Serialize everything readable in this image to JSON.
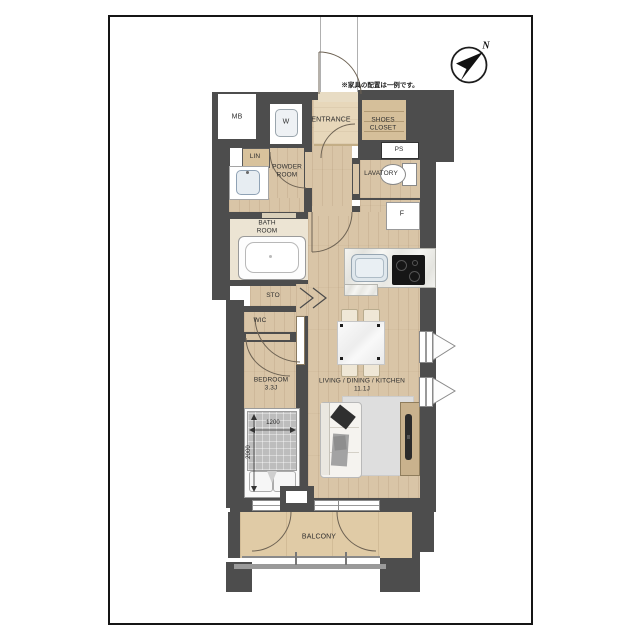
{
  "page": {
    "compass_n": "N",
    "furniture_note": "※家具の配置は一例です。"
  },
  "rooms": {
    "mb": "MB",
    "w": "W",
    "entrance": "ENTRANCE",
    "shoes_closet": "SHOES\nCLOSET",
    "ps": "PS",
    "lin": "LIN",
    "powder_room": "POWDER\nROOM",
    "lavatory": "LAVATORY",
    "bath_room": "BATH\nROOM",
    "f": "F",
    "sto": "STO",
    "wic": "WIC",
    "bedroom": "BEDROOM\n3.3J",
    "ldk": "LIVING / DINING / KITCHEN\n11.1J",
    "balcony": "BALCONY"
  },
  "dimensions": {
    "bed_width": "1200",
    "bed_length": "2000"
  },
  "colors": {
    "wall": "#4d4d4d",
    "wood": "#d9c5a7",
    "balcony_floor": "#e0cba6",
    "frame": "#151515"
  }
}
